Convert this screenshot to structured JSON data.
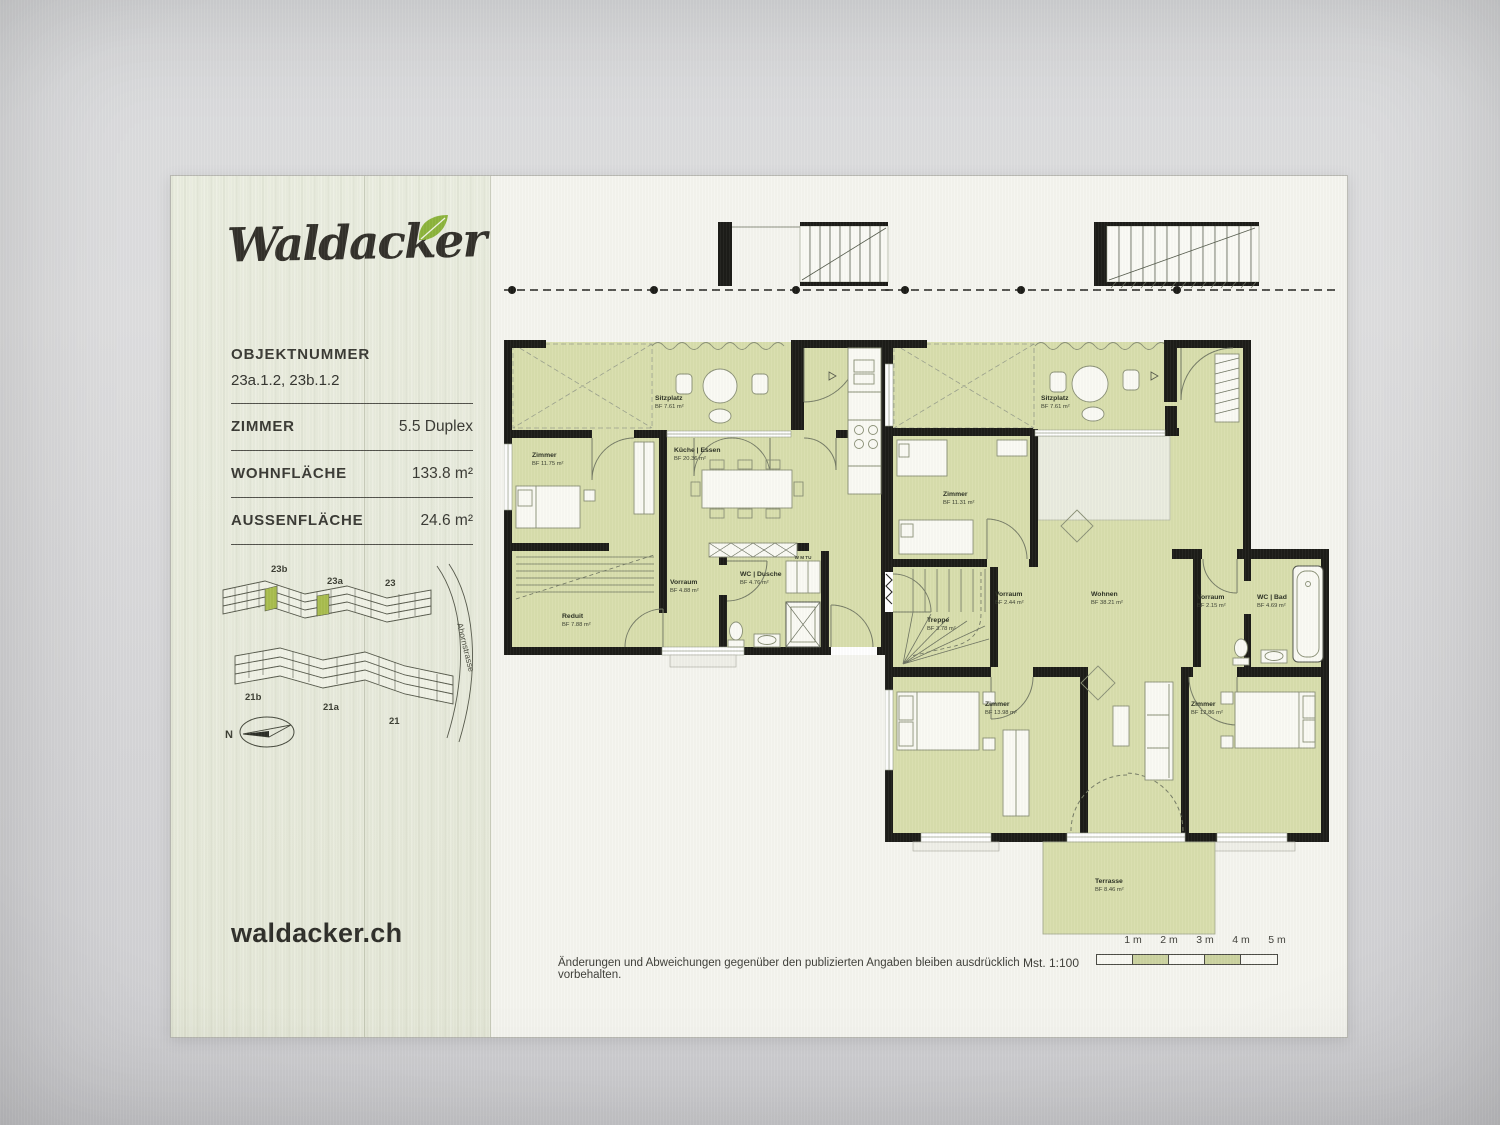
{
  "sidebar": {
    "logo": "Waldacker",
    "website": "waldacker.ch",
    "objektnummer": {
      "label": "OBJEKTNUMMER",
      "value": "23a.1.2, 23b.1.2"
    },
    "specs": [
      {
        "label": "ZIMMER",
        "value": "5.5 Duplex"
      },
      {
        "label": "WOHNFLÄCHE",
        "value": "133.8 m²"
      },
      {
        "label": "AUSSENFLÄCHE",
        "value": "24.6 m²"
      }
    ],
    "site_plan": {
      "buildings": [
        "23b",
        "23a",
        "23",
        "21b",
        "21a",
        "21"
      ],
      "street": "Ahornstrasse",
      "compass": "N"
    }
  },
  "plans": {
    "left": {
      "rooms": [
        {
          "name": "Sitzplatz",
          "area": "BF 7.61 m²"
        },
        {
          "name": "Zimmer",
          "area": "BF 11.75 m²"
        },
        {
          "name": "Küche | Essen",
          "area": "BF 20.36 m²"
        },
        {
          "name": "Vorraum",
          "area": "BF 4.88 m²"
        },
        {
          "name": "WC | Dusche",
          "area": "BF 4.76 m²"
        },
        {
          "name": "Reduit",
          "area": "BF 7.88 m²"
        }
      ],
      "appliances": "W M TU"
    },
    "right": {
      "rooms": [
        {
          "name": "Sitzplatz",
          "area": "BF 7.61 m²"
        },
        {
          "name": "Zimmer",
          "area": "BF 11.31 m²"
        },
        {
          "name": "Vorraum",
          "area": "BF 2.44 m²"
        },
        {
          "name": "Wohnen",
          "area": "BF 38.21 m²"
        },
        {
          "name": "Treppe",
          "area": "BF 3.78 m²"
        },
        {
          "name": "Vorraum",
          "area": "BF 2.15 m²"
        },
        {
          "name": "WC | Bad",
          "area": "BF 4.69 m²"
        },
        {
          "name": "Zimmer",
          "area": "BF 13.98 m²"
        },
        {
          "name": "Zimmer",
          "area": "BF 12.86 m²"
        },
        {
          "name": "Terrasse",
          "area": "BF 8.46 m²"
        }
      ]
    }
  },
  "footer": {
    "disclaimer": "Änderungen und Abweichungen gegenüber den publizierten Angaben bleiben ausdrücklich vorbehalten.",
    "scale": "Mst. 1:100",
    "scale_marks": [
      "1 m",
      "2 m",
      "3 m",
      "4 m",
      "5 m"
    ]
  },
  "colors": {
    "room_fill": "#d8dead",
    "wall": "#1c1c18",
    "wood_panel": "#e8ebdd",
    "leaf_green": "#8cb43c",
    "paper": "#f5f5ef"
  }
}
